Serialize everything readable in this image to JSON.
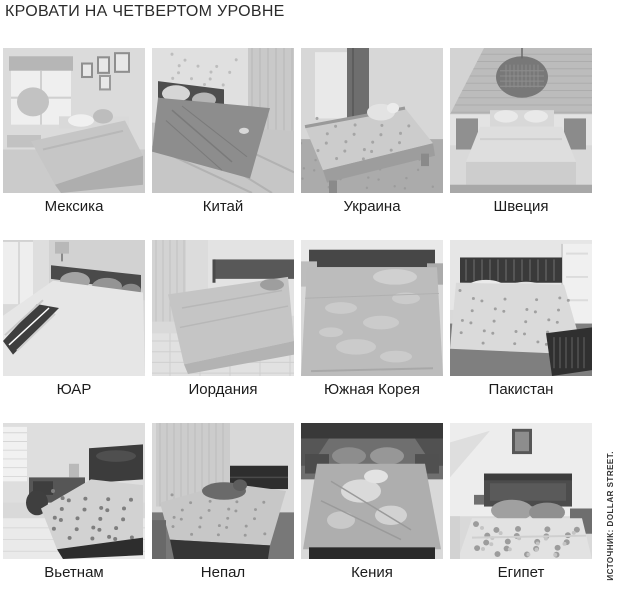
{
  "page": {
    "title": "КРОВАТИ НА ЧЕТВЕРТОМ УРОВНЕ",
    "source_note": "ИСТОЧНИК: DOLLAR STREET.",
    "colors": {
      "background": "#ffffff",
      "title_text": "#2b2b2b",
      "caption_text": "#1c1c1c",
      "source_text": "#333333",
      "photo_style": "grayscale"
    }
  },
  "grid": {
    "rows": 3,
    "columns": 4,
    "items": [
      {
        "key": "mexico",
        "label": "Мексика",
        "photo": "grayscale bedroom photo: bright room, large window left, framed pictures, light bed"
      },
      {
        "key": "china",
        "label": "Китай",
        "photo": "grayscale bedroom photo: gray satin duvet, dark headboard, curtains, wood floor"
      },
      {
        "key": "ukraine",
        "label": "Украина",
        "photo": "grayscale bedroom photo: wooden bed, patterned duvet, teddy bear, dark curtain"
      },
      {
        "key": "sweden",
        "label": "Швеция",
        "photo": "grayscale bedroom photo: attic wood-plank wall, wicker pendant lamp, white bed, two nightstands"
      },
      {
        "key": "yuar",
        "label": "ЮАР",
        "photo": "grayscale bedroom photo: white duvet with dark diagonal band, patterned pillows, window left"
      },
      {
        "key": "jordan",
        "label": "Иордания",
        "photo": "grayscale bedroom photo: smooth light coverlet, dark headboard, tiled floor, curtains left"
      },
      {
        "key": "korea",
        "label": "Южная Корея",
        "photo": "grayscale bedroom photo: quilted leaf-pattern coverlet filling frame, dark headboard, pillow"
      },
      {
        "key": "pakistan",
        "label": "Пакистан",
        "photo": "grayscale bedroom photo: floral sheet, dark slatted wooden headboard and footboard, door right"
      },
      {
        "key": "vietnam",
        "label": "Вьетнам",
        "photo": "grayscale bedroom photo: dark wooden bed with floral spread, desk and chair left, tiled floor"
      },
      {
        "key": "nepal",
        "label": "Непал",
        "photo": "grayscale bedroom photo: curtained wall, dark wood bed, floral sheet, person lying down"
      },
      {
        "key": "kenya",
        "label": "Кения",
        "photo": "grayscale bedroom photo: dark room, shiny bedspread with sunlit patches, pillows"
      },
      {
        "key": "egypt",
        "label": "Египет",
        "photo": "grayscale bedroom photo: bright wall, dark wood headboard, gray pillows, polka-dot blanket"
      }
    ]
  }
}
